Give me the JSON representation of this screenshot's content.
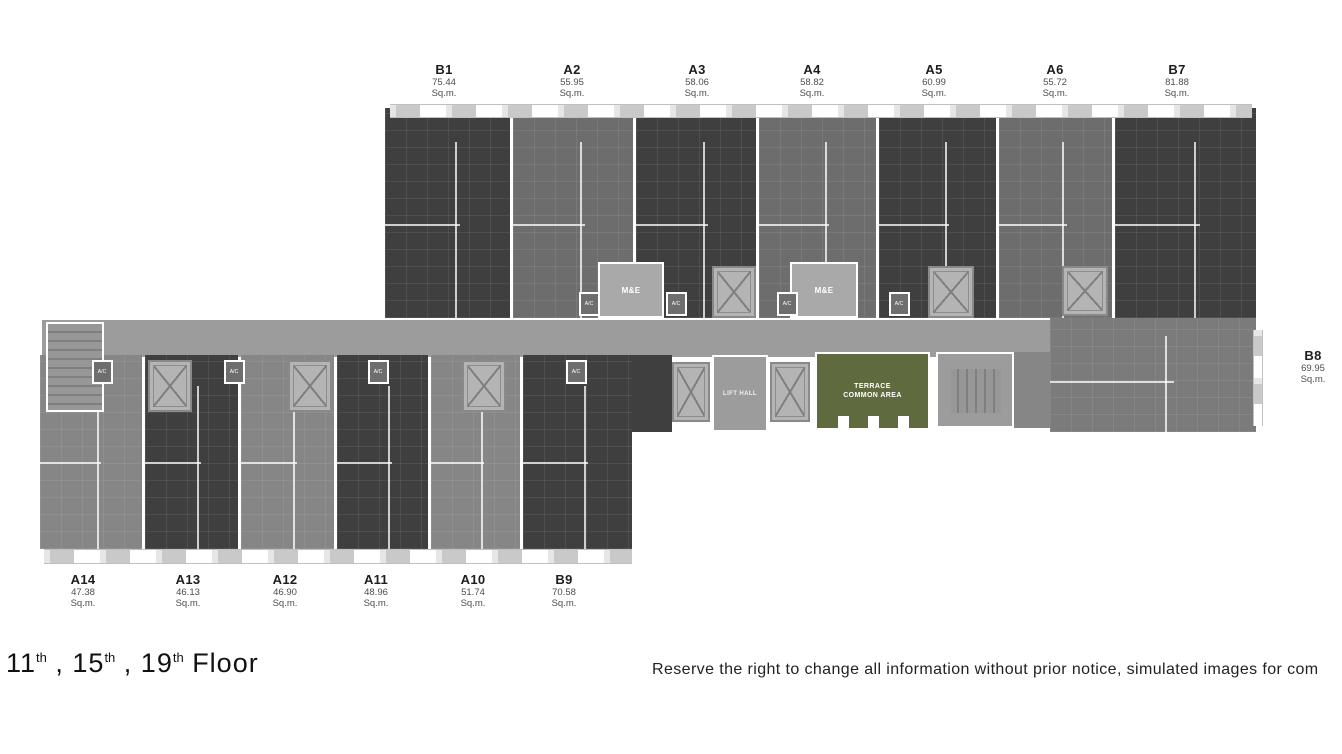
{
  "footer": {
    "floors": [
      {
        "number": "11",
        "suffix": "th"
      },
      {
        "number": "15",
        "suffix": "th"
      },
      {
        "number": "19",
        "suffix": "th"
      }
    ],
    "separator": " , ",
    "word": " Floor",
    "disclaimer": "Reserve the right to change all information without prior notice, simulated images for com"
  },
  "units": {
    "top_row": [
      {
        "name": "B1",
        "area": "75.44",
        "unit": "Sq.m."
      },
      {
        "name": "A2",
        "area": "55.95",
        "unit": "Sq.m."
      },
      {
        "name": "A3",
        "area": "58.06",
        "unit": "Sq.m."
      },
      {
        "name": "A4",
        "area": "58.82",
        "unit": "Sq.m."
      },
      {
        "name": "A5",
        "area": "60.99",
        "unit": "Sq.m."
      },
      {
        "name": "A6",
        "area": "55.72",
        "unit": "Sq.m."
      },
      {
        "name": "B7",
        "area": "81.88",
        "unit": "Sq.m."
      }
    ],
    "right_side": [
      {
        "name": "B8",
        "area": "69.95",
        "unit": "Sq.m."
      }
    ],
    "bottom_row": [
      {
        "name": "A14",
        "area": "47.38",
        "unit": "Sq.m."
      },
      {
        "name": "A13",
        "area": "46.13",
        "unit": "Sq.m."
      },
      {
        "name": "A12",
        "area": "46.90",
        "unit": "Sq.m."
      },
      {
        "name": "A11",
        "area": "48.96",
        "unit": "Sq.m."
      },
      {
        "name": "A10",
        "area": "51.74",
        "unit": "Sq.m."
      },
      {
        "name": "B9",
        "area": "70.58",
        "unit": "Sq.m."
      }
    ]
  },
  "plan_labels": {
    "lift_hall": "LIFT HALL",
    "terrace_line1": "TERRACE",
    "terrace_line2": "COMMON AREA",
    "me": "M&E",
    "ac": "A/C"
  },
  "colors": {
    "unit_dark": "#3f3f3f",
    "unit_mid": "#6d6d6d",
    "unit_light": "#868686",
    "unit_b8": "#7b7b7b",
    "corridor": "#9c9c9c",
    "me_room": "#a9a9a9",
    "lift_shaft": "#b4b4b4",
    "stair": "#979797",
    "terrace": "#5f6b3f",
    "text_dark": "#1d1d1d",
    "text_muted": "#4d4d4d"
  }
}
